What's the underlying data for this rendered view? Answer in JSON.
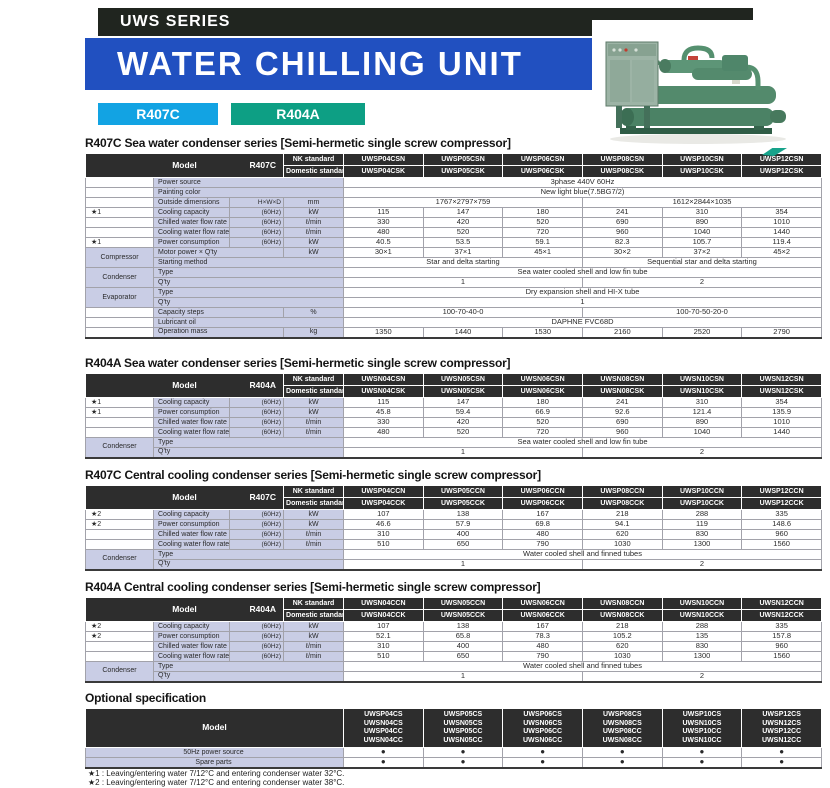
{
  "header": {
    "series_label": "UWS SERIES",
    "title": "WATER CHILLING UNIT",
    "badges": [
      {
        "label": "R407C",
        "color": "#12a3e3"
      },
      {
        "label": "R404A",
        "color": "#0d9f84"
      }
    ],
    "photo_alt": "green semi-hermetic screw water chilling unit with control panel"
  },
  "colors": {
    "bar_black": "#20251f",
    "bar_blue": "#2150c0",
    "label_bg": "#c9cde5",
    "header_bg": "#2d2d2d"
  },
  "tables": [
    {
      "title": "R407C Sea water condenser series",
      "subtitle": "Semi-hermetic single screw compressor",
      "model": {
        "label": "Model",
        "refrigerant": "R407C",
        "nk_label": "NK standard",
        "domestic_label": "Domestic standard",
        "nk": [
          "UWSP04CSN",
          "UWSP05CSN",
          "UWSP06CSN",
          "UWSP08CSN",
          "UWSP10CSN",
          "UWSP12CSN"
        ],
        "domestic": [
          "UWSP04CSK",
          "UWSP05CSK",
          "UWSP06CSK",
          "UWSP08CSK",
          "UWSP10CSK",
          "UWSP12CSK"
        ]
      },
      "rows": [
        {
          "label": "Power source",
          "wide": true,
          "cells": [
            {
              "t": "3phase 440V  60Hz",
              "s": 6
            }
          ]
        },
        {
          "label": "Painting color",
          "wide": true,
          "cells": [
            {
              "t": "New light blue(7.5BG7/2)",
              "s": 6
            }
          ]
        },
        {
          "label": "Outside dimensions",
          "sub": "H×W×D",
          "unit": "mm",
          "cells": [
            {
              "t": "1767×2797×759",
              "s": 3
            },
            {
              "t": "1612×2844×1035",
              "s": 3
            }
          ]
        },
        {
          "star": "★1",
          "label": "Cooling capacity",
          "sub": "(60Hz)",
          "unit": "kW",
          "cells": [
            {
              "t": "115"
            },
            {
              "t": "147"
            },
            {
              "t": "180"
            },
            {
              "t": "241"
            },
            {
              "t": "310"
            },
            {
              "t": "354"
            }
          ]
        },
        {
          "label": "Chilled water flow rate",
          "sub": "(60Hz)",
          "unit": "ℓ/min",
          "cells": [
            {
              "t": "330"
            },
            {
              "t": "420"
            },
            {
              "t": "520"
            },
            {
              "t": "690"
            },
            {
              "t": "890"
            },
            {
              "t": "1010"
            }
          ]
        },
        {
          "label": "Cooling water flow rate",
          "sub": "(60Hz)",
          "unit": "ℓ/min",
          "cells": [
            {
              "t": "480"
            },
            {
              "t": "520"
            },
            {
              "t": "720"
            },
            {
              "t": "960"
            },
            {
              "t": "1040"
            },
            {
              "t": "1440"
            }
          ]
        },
        {
          "star": "★1",
          "label": "Power consumption",
          "sub": "(60Hz)",
          "unit": "kW",
          "cells": [
            {
              "t": "40.5"
            },
            {
              "t": "53.5"
            },
            {
              "t": "59.1"
            },
            {
              "t": "82.3"
            },
            {
              "t": "105.7"
            },
            {
              "t": "119.4"
            }
          ]
        },
        {
          "group": {
            "label": "Compressor",
            "span": 2
          },
          "label": "Motor power × Q'ty",
          "unit": "kW",
          "cells": [
            {
              "t": "30×1"
            },
            {
              "t": "37×1"
            },
            {
              "t": "45×1"
            },
            {
              "t": "30×2"
            },
            {
              "t": "37×2"
            },
            {
              "t": "45×2"
            }
          ]
        },
        {
          "groupCont": true,
          "label": "Starting method",
          "wide": true,
          "cells": [
            {
              "t": "Star and delta starting",
              "s": 3
            },
            {
              "t": "Sequential star and delta starting",
              "s": 3
            }
          ]
        },
        {
          "group": {
            "label": "Condenser",
            "span": 2
          },
          "label": "Type",
          "wide": true,
          "cells": [
            {
              "t": "Sea water cooled shell and low fin tube",
              "s": 6
            }
          ]
        },
        {
          "groupCont": true,
          "label": "Q'ty",
          "wide": true,
          "cells": [
            {
              "t": "1",
              "s": 3
            },
            {
              "t": "2",
              "s": 3
            }
          ]
        },
        {
          "group": {
            "label": "Evaporator",
            "span": 2
          },
          "label": "Type",
          "wide": true,
          "cells": [
            {
              "t": "Dry expansion shell and HI-X tube",
              "s": 6
            }
          ]
        },
        {
          "groupCont": true,
          "label": "Q'ty",
          "wide": true,
          "cells": [
            {
              "t": "1",
              "s": 6
            }
          ]
        },
        {
          "label": "Capacity steps",
          "unit": "%",
          "cells": [
            {
              "t": "100-70-40-0",
              "s": 3
            },
            {
              "t": "100-70-50-20-0",
              "s": 3
            }
          ]
        },
        {
          "label": "Lubricant oil",
          "wide": true,
          "cells": [
            {
              "t": "DAPHNE FVC68D",
              "s": 6
            }
          ]
        },
        {
          "label": "Operation mass",
          "unit": "kg",
          "cells": [
            {
              "t": "1350"
            },
            {
              "t": "1440"
            },
            {
              "t": "1530"
            },
            {
              "t": "2160"
            },
            {
              "t": "2520"
            },
            {
              "t": "2790"
            }
          ]
        }
      ]
    },
    {
      "title": "R404A Sea water condenser series",
      "subtitle": "Semi-hermetic single screw compressor",
      "model": {
        "label": "Model",
        "refrigerant": "R404A",
        "nk_label": "NK standard",
        "domestic_label": "Domestic standard",
        "nk": [
          "UWSN04CSN",
          "UWSN05CSN",
          "UWSN06CSN",
          "UWSN08CSN",
          "UWSN10CSN",
          "UWSN12CSN"
        ],
        "domestic": [
          "UWSN04CSK",
          "UWSN05CSK",
          "UWSN06CSK",
          "UWSN08CSK",
          "UWSN10CSK",
          "UWSN12CSK"
        ]
      },
      "rows": [
        {
          "star": "★1",
          "label": "Cooling capacity",
          "sub": "(60Hz)",
          "unit": "kW",
          "cells": [
            {
              "t": "115"
            },
            {
              "t": "147"
            },
            {
              "t": "180"
            },
            {
              "t": "241"
            },
            {
              "t": "310"
            },
            {
              "t": "354"
            }
          ]
        },
        {
          "star": "★1",
          "label": "Power consumption",
          "sub": "(60Hz)",
          "unit": "kW",
          "cells": [
            {
              "t": "45.8"
            },
            {
              "t": "59.4"
            },
            {
              "t": "66.9"
            },
            {
              "t": "92.6"
            },
            {
              "t": "121.4"
            },
            {
              "t": "135.9"
            }
          ]
        },
        {
          "label": "Chilled water flow rate",
          "sub": "(60Hz)",
          "unit": "ℓ/min",
          "cells": [
            {
              "t": "330"
            },
            {
              "t": "420"
            },
            {
              "t": "520"
            },
            {
              "t": "690"
            },
            {
              "t": "890"
            },
            {
              "t": "1010"
            }
          ]
        },
        {
          "label": "Cooling water flow rate",
          "sub": "(60Hz)",
          "unit": "ℓ/min",
          "cells": [
            {
              "t": "480"
            },
            {
              "t": "520"
            },
            {
              "t": "720"
            },
            {
              "t": "960"
            },
            {
              "t": "1040"
            },
            {
              "t": "1440"
            }
          ]
        },
        {
          "group": {
            "label": "Condenser",
            "span": 2
          },
          "label": "Type",
          "wide": true,
          "cells": [
            {
              "t": "Sea water cooled shell and low fin tube",
              "s": 6
            }
          ]
        },
        {
          "groupCont": true,
          "label": "Q'ty",
          "wide": true,
          "cells": [
            {
              "t": "1",
              "s": 3
            },
            {
              "t": "2",
              "s": 3
            }
          ]
        }
      ]
    },
    {
      "title": "R407C Central cooling condenser series",
      "subtitle": "Semi-hermetic single screw compressor",
      "model": {
        "label": "Model",
        "refrigerant": "R407C",
        "nk_label": "NK standard",
        "domestic_label": "Domestic standard",
        "nk": [
          "UWSP04CCN",
          "UWSP05CCN",
          "UWSP06CCN",
          "UWSP08CCN",
          "UWSP10CCN",
          "UWSP12CCN"
        ],
        "domestic": [
          "UWSP04CCK",
          "UWSP05CCK",
          "UWSP06CCK",
          "UWSP08CCK",
          "UWSP10CCK",
          "UWSP12CCK"
        ]
      },
      "rows": [
        {
          "star": "★2",
          "label": "Cooling capacity",
          "sub": "(60Hz)",
          "unit": "kW",
          "cells": [
            {
              "t": "107"
            },
            {
              "t": "138"
            },
            {
              "t": "167"
            },
            {
              "t": "218"
            },
            {
              "t": "288"
            },
            {
              "t": "335"
            }
          ]
        },
        {
          "star": "★2",
          "label": "Power consumption",
          "sub": "(60Hz)",
          "unit": "kW",
          "cells": [
            {
              "t": "46.6"
            },
            {
              "t": "57.9"
            },
            {
              "t": "69.8"
            },
            {
              "t": "94.1"
            },
            {
              "t": "119"
            },
            {
              "t": "148.6"
            }
          ]
        },
        {
          "label": "Chilled water flow rate",
          "sub": "(60Hz)",
          "unit": "ℓ/min",
          "cells": [
            {
              "t": "310"
            },
            {
              "t": "400"
            },
            {
              "t": "480"
            },
            {
              "t": "620"
            },
            {
              "t": "830"
            },
            {
              "t": "960"
            }
          ]
        },
        {
          "label": "Cooling water flow rate",
          "sub": "(60Hz)",
          "unit": "ℓ/min",
          "cells": [
            {
              "t": "510"
            },
            {
              "t": "650"
            },
            {
              "t": "790"
            },
            {
              "t": "1030"
            },
            {
              "t": "1300"
            },
            {
              "t": "1560"
            }
          ]
        },
        {
          "group": {
            "label": "Condenser",
            "span": 2
          },
          "label": "Type",
          "wide": true,
          "cells": [
            {
              "t": "Water cooled shell and finned tubes",
              "s": 6
            }
          ]
        },
        {
          "groupCont": true,
          "label": "Q'ty",
          "wide": true,
          "cells": [
            {
              "t": "1",
              "s": 3
            },
            {
              "t": "2",
              "s": 3
            }
          ]
        }
      ]
    },
    {
      "title": "R404A Central cooling condenser series",
      "subtitle": "Semi-hermetic single screw compressor",
      "model": {
        "label": "Model",
        "refrigerant": "R404A",
        "nk_label": "NK standard",
        "domestic_label": "Domestic standard",
        "nk": [
          "UWSN04CCN",
          "UWSN05CCN",
          "UWSN06CCN",
          "UWSN08CCN",
          "UWSN10CCN",
          "UWSN12CCN"
        ],
        "domestic": [
          "UWSN04CCK",
          "UWSN05CCK",
          "UWSN06CCK",
          "UWSN08CCK",
          "UWSN10CCK",
          "UWSN12CCK"
        ]
      },
      "rows": [
        {
          "star": "★2",
          "label": "Cooling capacity",
          "sub": "(60Hz)",
          "unit": "kW",
          "cells": [
            {
              "t": "107"
            },
            {
              "t": "138"
            },
            {
              "t": "167"
            },
            {
              "t": "218"
            },
            {
              "t": "288"
            },
            {
              "t": "335"
            }
          ]
        },
        {
          "star": "★2",
          "label": "Power consumption",
          "sub": "(60Hz)",
          "unit": "kW",
          "cells": [
            {
              "t": "52.1"
            },
            {
              "t": "65.8"
            },
            {
              "t": "78.3"
            },
            {
              "t": "105.2"
            },
            {
              "t": "135"
            },
            {
              "t": "157.8"
            }
          ]
        },
        {
          "label": "Chilled water flow rate",
          "sub": "(60Hz)",
          "unit": "ℓ/min",
          "cells": [
            {
              "t": "310"
            },
            {
              "t": "400"
            },
            {
              "t": "480"
            },
            {
              "t": "620"
            },
            {
              "t": "830"
            },
            {
              "t": "960"
            }
          ]
        },
        {
          "label": "Cooling water flow rate",
          "sub": "(60Hz)",
          "unit": "ℓ/min",
          "cells": [
            {
              "t": "510"
            },
            {
              "t": "650"
            },
            {
              "t": "790"
            },
            {
              "t": "1030"
            },
            {
              "t": "1300"
            },
            {
              "t": "1560"
            }
          ]
        },
        {
          "group": {
            "label": "Condenser",
            "span": 2
          },
          "label": "Type",
          "wide": true,
          "cells": [
            {
              "t": "Water cooled shell and finned tubes",
              "s": 6
            }
          ]
        },
        {
          "groupCont": true,
          "label": "Q'ty",
          "wide": true,
          "cells": [
            {
              "t": "1",
              "s": 3
            },
            {
              "t": "2",
              "s": 3
            }
          ]
        }
      ]
    }
  ],
  "optional": {
    "title": "Optional specification",
    "model_label": "Model",
    "columns": [
      [
        "UWSP04CS",
        "UWSN04CS",
        "UWSP04CC",
        "UWSN04CC"
      ],
      [
        "UWSP05CS",
        "UWSN05CS",
        "UWSP05CC",
        "UWSN05CC"
      ],
      [
        "UWSP06CS",
        "UWSN06CS",
        "UWSP06CC",
        "UWSN06CC"
      ],
      [
        "UWSP08CS",
        "UWSN08CS",
        "UWSP08CC",
        "UWSN08CC"
      ],
      [
        "UWSP10CS",
        "UWSN10CS",
        "UWSP10CC",
        "UWSN10CC"
      ],
      [
        "UWSP12CS",
        "UWSN12CS",
        "UWSP12CC",
        "UWSN12CC"
      ]
    ],
    "rows": [
      {
        "label": "50Hz power source",
        "dot": "●"
      },
      {
        "label": "Spare parts",
        "dot": "●"
      }
    ]
  },
  "footnotes": [
    "★1 : Leaving/entering water 7/12°C and entering condenser water 32°C.",
    "★2 : Leaving/entering water 7/12°C and entering condenser water 38°C."
  ]
}
